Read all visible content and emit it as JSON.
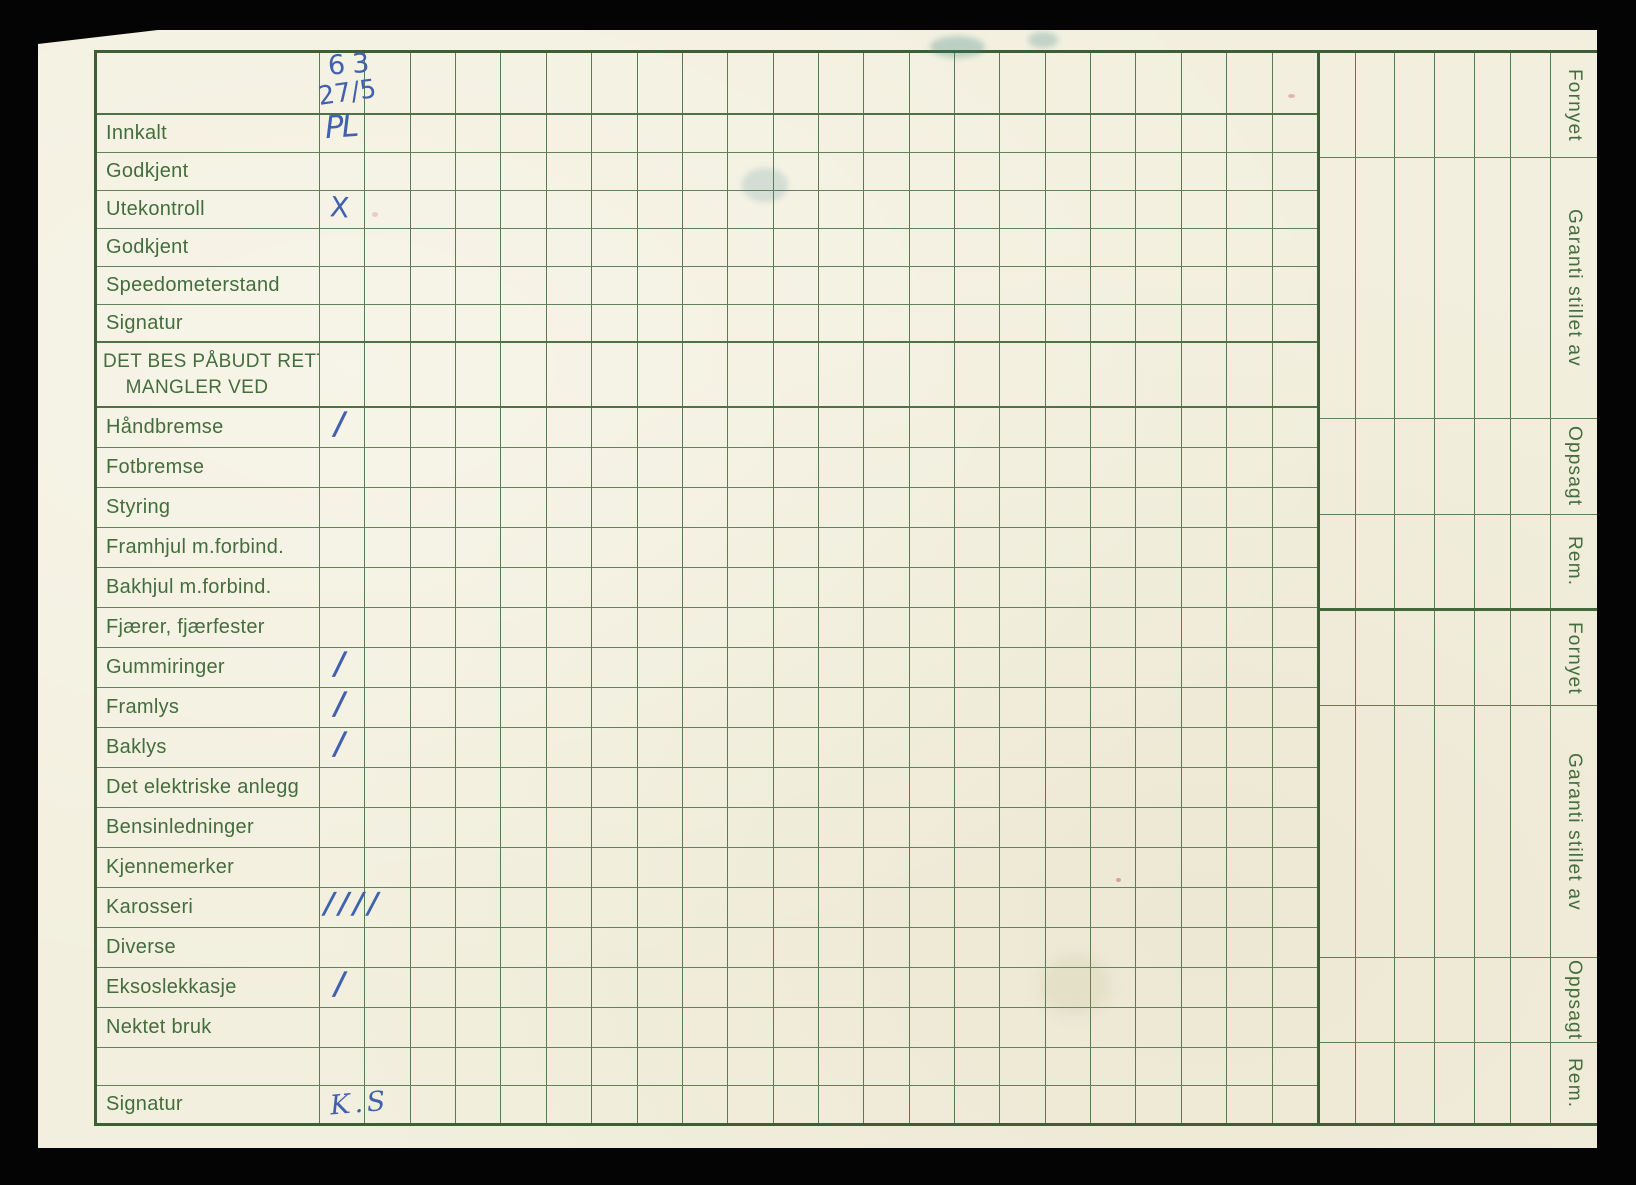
{
  "card": {
    "header_marks": {
      "year": "63",
      "date": "27/5"
    },
    "top_rows": [
      {
        "label": "Innkalt",
        "mark": "PL"
      },
      {
        "label": "Godkjent",
        "mark": ""
      },
      {
        "label": "Utekontroll",
        "mark": "X"
      },
      {
        "label": "Godkjent",
        "mark": ""
      },
      {
        "label": "Speedometerstand",
        "mark": ""
      },
      {
        "label": "Signatur",
        "mark": ""
      }
    ],
    "section_header_line1": "DET BES PÅBUDT RETTET",
    "section_header_line2": "MANGLER VED",
    "defect_rows": [
      {
        "label": "Håndbremse",
        "mark": "/"
      },
      {
        "label": "Fotbremse",
        "mark": ""
      },
      {
        "label": "Styring",
        "mark": ""
      },
      {
        "label": "Framhjul m.forbind.",
        "mark": ""
      },
      {
        "label": "Bakhjul m.forbind.",
        "mark": ""
      },
      {
        "label": "Fjærer, fjærfester",
        "mark": ""
      },
      {
        "label": "Gummiringer",
        "mark": "/"
      },
      {
        "label": "Framlys",
        "mark": "/"
      },
      {
        "label": "Baklys",
        "mark": "/"
      },
      {
        "label": "Det elektriske anlegg",
        "mark": ""
      },
      {
        "label": "Bensinledninger",
        "mark": ""
      },
      {
        "label": "Kjennemerker",
        "mark": ""
      },
      {
        "label": "Karosseri",
        "mark": "////"
      },
      {
        "label": "Diverse",
        "mark": ""
      },
      {
        "label": "Eksoslekkasje",
        "mark": "/"
      },
      {
        "label": "Nektet bruk",
        "mark": ""
      },
      {
        "label": "",
        "mark": ""
      },
      {
        "label": "Signatur",
        "mark": "K.S"
      }
    ],
    "right_sections": [
      "Fornyet",
      "Garanti stillet av",
      "Oppsagt",
      "Rem.",
      "Fornyet",
      "Garanti stillet av",
      "Oppsagt",
      "Rem."
    ],
    "colors": {
      "paper": "#f2efde",
      "grid_line": "#5f8052",
      "grid_border": "#3c5f36",
      "label_text": "#436d3c",
      "ink": "#4160ae"
    }
  }
}
